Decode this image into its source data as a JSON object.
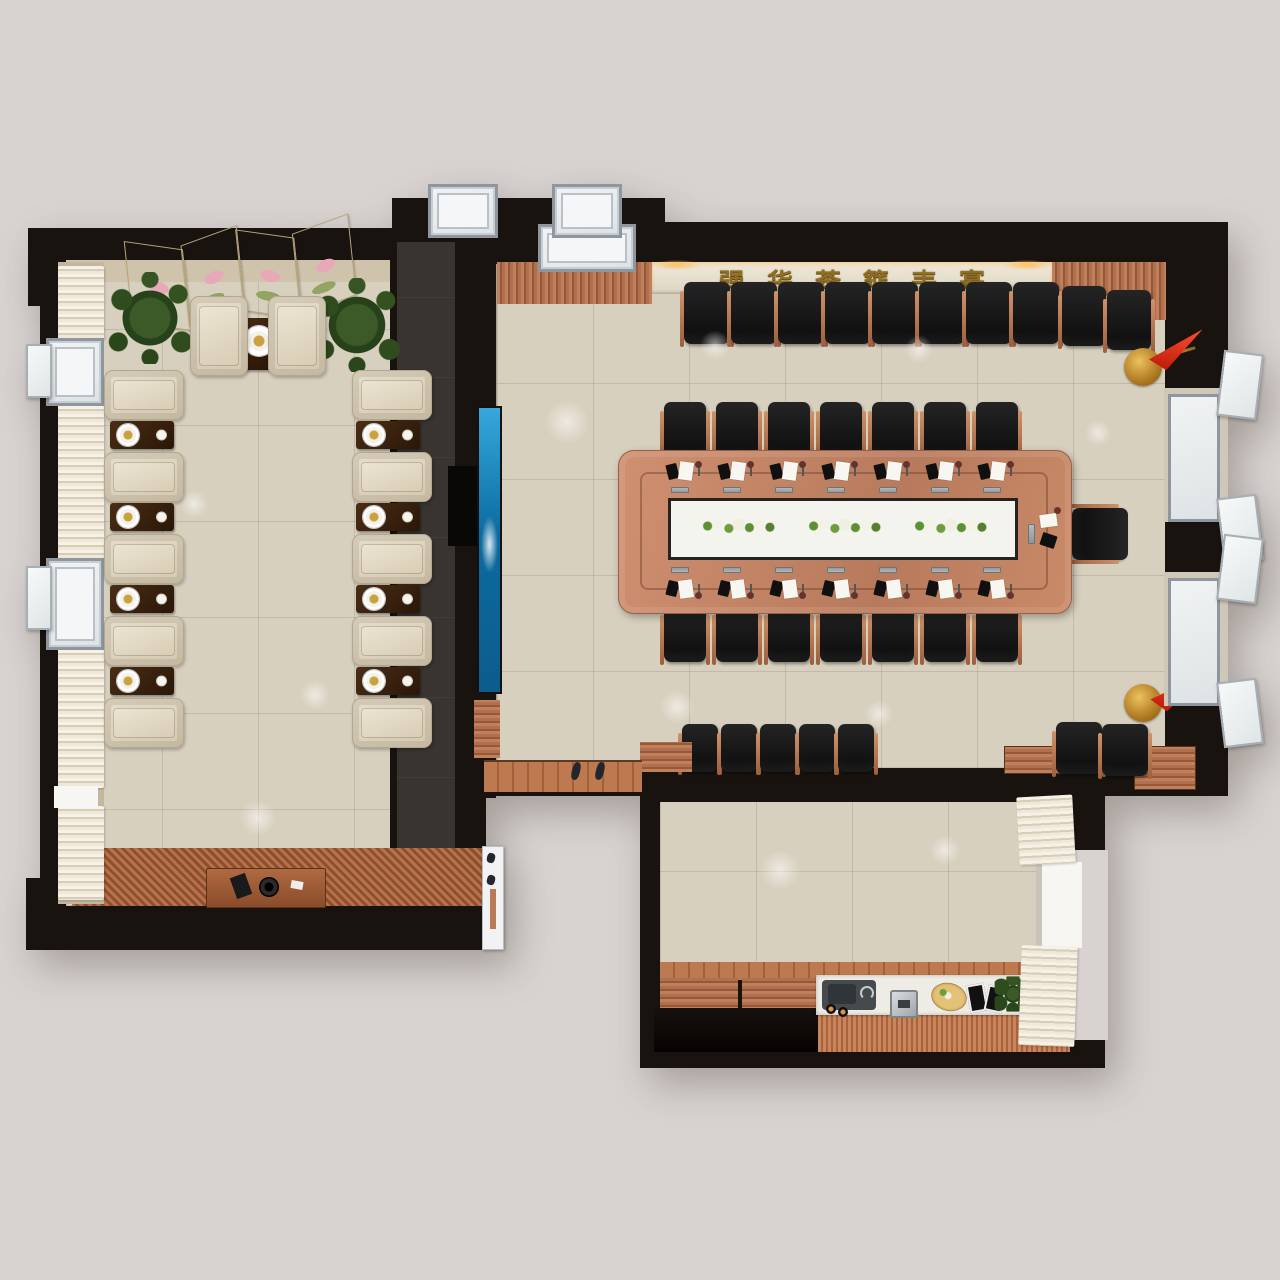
{
  "scene": {
    "view": "top-down-3d-interior-render",
    "rooms": [
      "reception-lounge",
      "corridor",
      "conference-room",
      "tea-pantry"
    ]
  },
  "sign": {
    "text": "强华茶筵丰宴"
  },
  "counts": {
    "conference_table_seats": 15,
    "table_side_chairs_per_row": 7,
    "head_chairs": 1,
    "wall_chairs_top_row": 8,
    "wall_chairs_bottom_row": 5,
    "corner_chair_pairs": 2,
    "reception_armchairs": 12,
    "tea_side_tables": 9,
    "flower_centerpieces": 3,
    "red_flags": 2,
    "potted_plants": 2,
    "right_wall_windows": 2,
    "top_skylight_windows": 2,
    "left_wall_windows": 2
  },
  "colors": {
    "bg": "#d8d3d1",
    "wall": "#191310",
    "floor": "#d8d0bf",
    "corridor": "#393430",
    "copper": "#9c5f3d",
    "chair": "#141414",
    "cream": "#d3c8b0",
    "table": "#b87a5c",
    "darktable": "#2a1708",
    "blue2": "#0b6ba0",
    "red": "#b51505",
    "gold": "#caa13f",
    "signbg": "#ddd5c2",
    "signtext": "#8f6f26",
    "deck": "#b9744c",
    "counter": "#efece6",
    "glass": "#f4f6f7",
    "frame": "#8f969e",
    "plant": "#27421a",
    "white": "#f4f4ee"
  }
}
